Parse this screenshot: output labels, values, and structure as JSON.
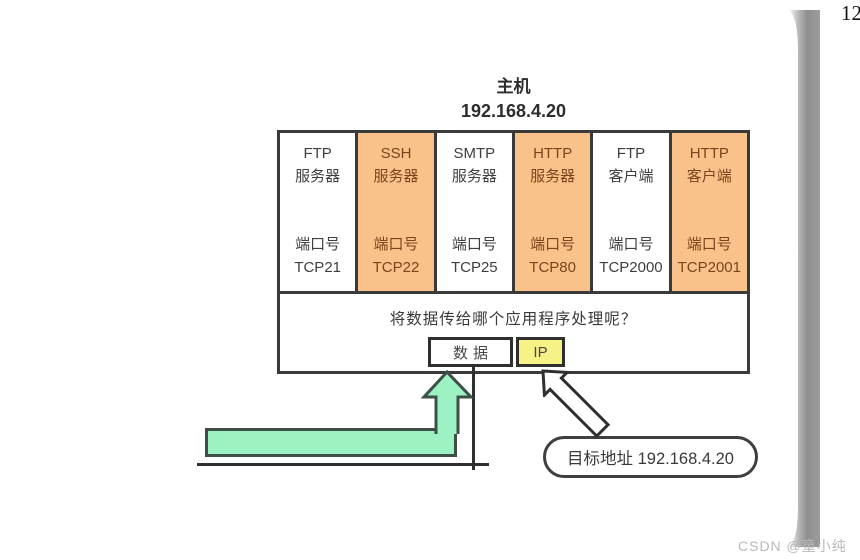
{
  "page": {
    "page_number": "12",
    "watermark": "CSDN @童小纯"
  },
  "host": {
    "title": "主机",
    "ip": "192.168.4.20"
  },
  "columns": [
    {
      "name_line1": "FTP",
      "name_line2": "服务器",
      "port_label": "端口号",
      "port": "TCP21",
      "highlight": false
    },
    {
      "name_line1": "SSH",
      "name_line2": "服务器",
      "port_label": "端口号",
      "port": "TCP22",
      "highlight": true
    },
    {
      "name_line1": "SMTP",
      "name_line2": "服务器",
      "port_label": "端口号",
      "port": "TCP25",
      "highlight": false
    },
    {
      "name_line1": "HTTP",
      "name_line2": "服务器",
      "port_label": "端口号",
      "port": "TCP80",
      "highlight": true
    },
    {
      "name_line1": "FTP",
      "name_line2": "客户端",
      "port_label": "端口号",
      "port": "TCP2000",
      "highlight": false
    },
    {
      "name_line1": "HTTP",
      "name_line2": "客户端",
      "port_label": "端口号",
      "port": "TCP2001",
      "highlight": true
    }
  ],
  "question": "将数据传给哪个应用程序处理呢？",
  "packet": {
    "data": "数据",
    "ip": "IP"
  },
  "destination": "目标地址 192.168.4.20",
  "colors": {
    "highlight_column": "#f8c28a",
    "highlight_text": "#7e431c",
    "ip_box": "#f5f286",
    "green_fill": "#9df2c3",
    "green_border": "#3e4f46",
    "table_border": "#3a3a3a"
  }
}
